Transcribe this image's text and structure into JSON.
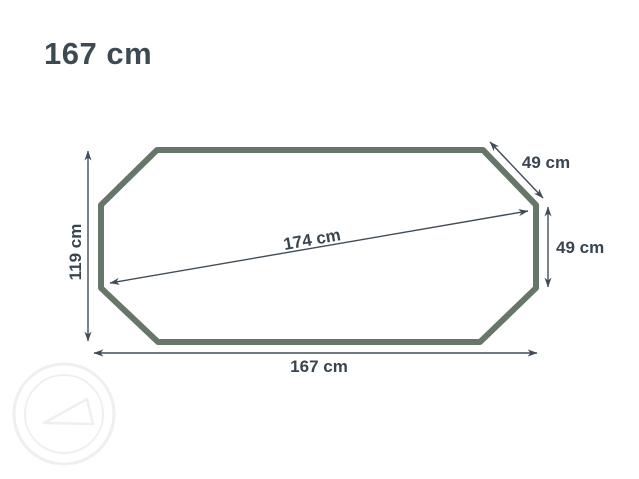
{
  "title": "167 cm",
  "colors": {
    "background": "#ffffff",
    "shape_stroke": "#667769",
    "arrow": "#414c57",
    "label_text": "#384551",
    "title_text": "#3e4a52",
    "watermark": "#efefef"
  },
  "measurements": {
    "left_height": "119 cm",
    "bottom_width": "167 cm",
    "top_corner": "49 cm",
    "right_side": "49 cm",
    "diagonal": "174 cm"
  },
  "shape": {
    "kind": "elongated-octagon-outline"
  },
  "watermark": {
    "icon": "circular-stamp-with-triangle-logo"
  }
}
